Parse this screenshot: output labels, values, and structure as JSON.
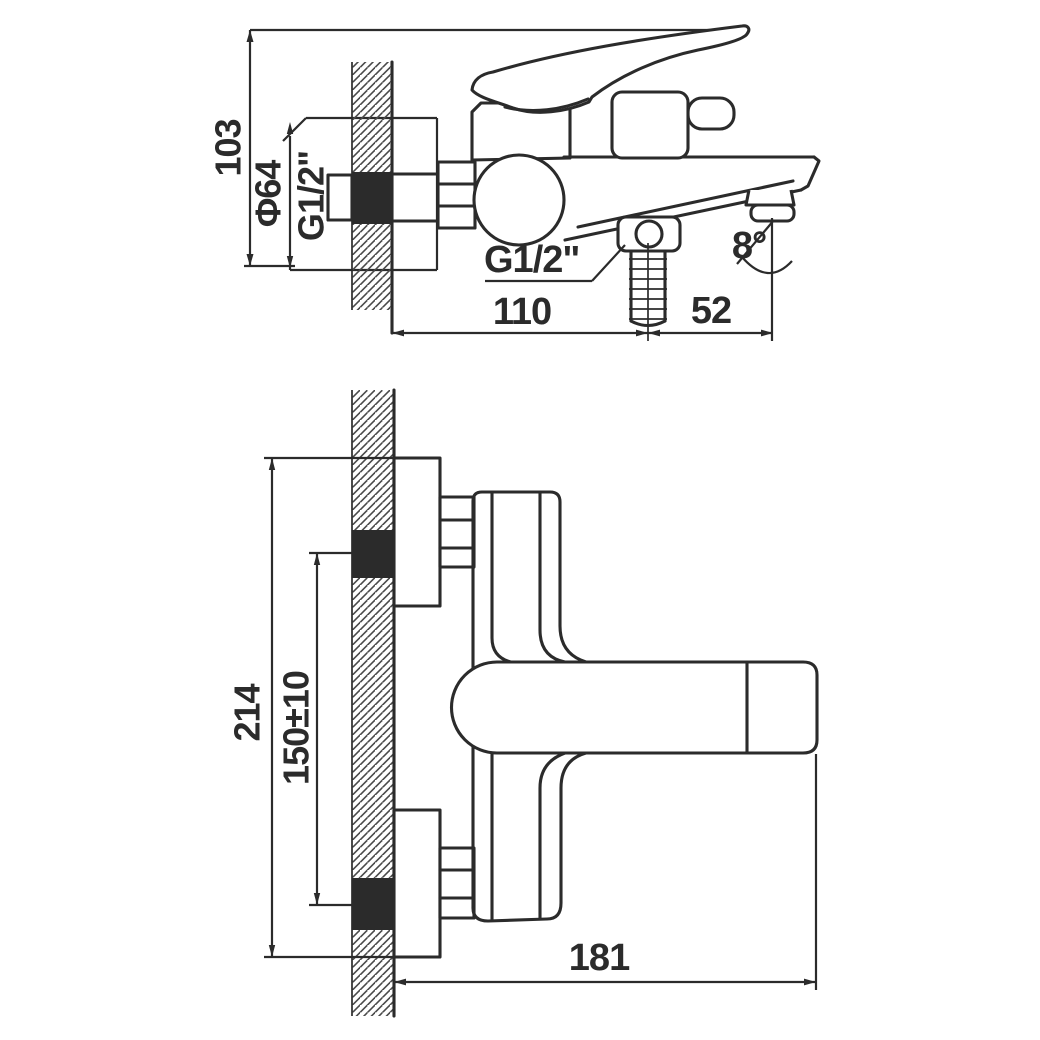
{
  "drawing_title": "Wall-mounted bath mixer installation drawing",
  "colors": {
    "ink": "#2b2b2b",
    "paper": "#ffffff",
    "hatch": "#4a4a4a"
  },
  "top_view": {
    "height_label": "103",
    "flange_diameter_label": "Φ64",
    "wall_thread_label": "G1/2\"",
    "shower_thread_label": "G1/2\"",
    "wall_to_shower_label": "110",
    "shower_to_spout_label": "52",
    "spout_angle_label": "8°"
  },
  "front_view": {
    "overall_height_label": "214",
    "supply_spacing_label": "150±10",
    "spout_reach_label": "181"
  }
}
